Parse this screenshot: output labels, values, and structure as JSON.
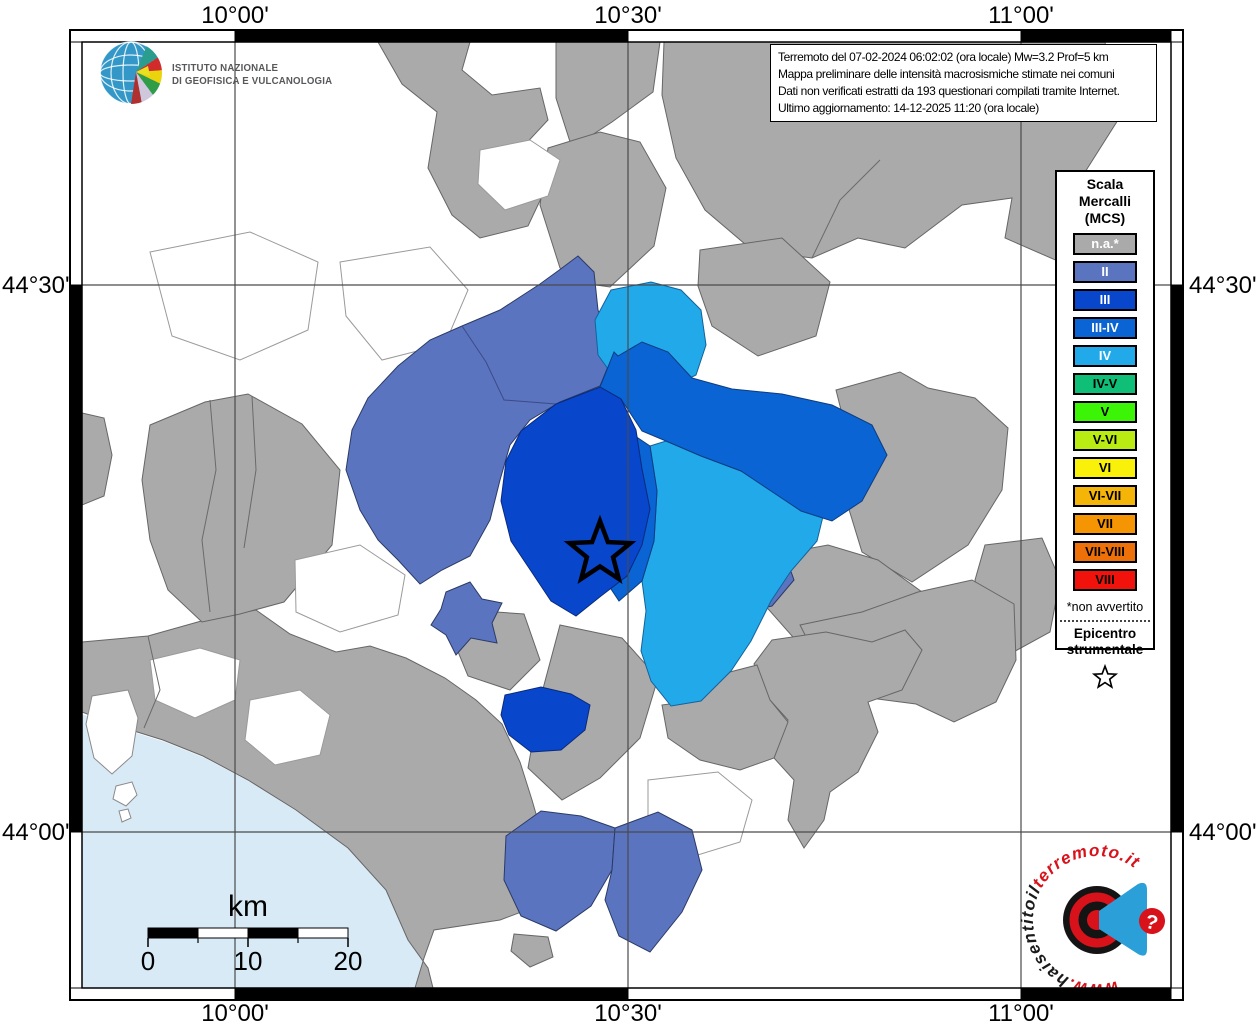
{
  "palette": {
    "na": "#aaaaaa",
    "II": "#5b74c0",
    "III": "#0846cc",
    "III_IV": "#0a64d4",
    "IV": "#22a9ea",
    "IV_V": "#10bf77",
    "V": "#3cf405",
    "V_VI": "#b9ec12",
    "VI": "#f9f10a",
    "VI_VII": "#f4b408",
    "VII": "#f69504",
    "VII_VIII": "#ee7008",
    "VIII": "#f2120c",
    "sea": "#d9eaf7",
    "white_region": "#ffffff",
    "grid": "#4a4a4a",
    "border": "#6b6b6b"
  },
  "ingv_logo": {
    "line1": "ISTITUTO NAZIONALE",
    "line2": "DI GEOFISICA E VULCANOLOGIA"
  },
  "info_box": {
    "lines": [
      "Terremoto del 07-02-2024 06:02:02 (ora locale) Mw=3.2 Prof=5 km",
      "Mappa preliminare delle intensità macrosismiche stimate nei comuni",
      "Dati non verificati estratti da 193 questionari compilati tramite Internet.",
      "Ultimo aggiornamento: 14-12-2025 11:20 (ora locale)"
    ]
  },
  "legend": {
    "title_lines": [
      "Scala",
      "Mercalli",
      "(MCS)"
    ],
    "items": [
      {
        "label": "n.a.*"
      },
      {
        "label": "II"
      },
      {
        "label": "III"
      },
      {
        "label": "III-IV"
      },
      {
        "label": "IV"
      },
      {
        "label": "IV-V"
      },
      {
        "label": "V"
      },
      {
        "label": "V-VI"
      },
      {
        "label": "VI"
      },
      {
        "label": "VI-VII"
      },
      {
        "label": "VII"
      },
      {
        "label": "VII-VIII"
      },
      {
        "label": "VIII"
      }
    ],
    "footnote": "*non avvertito",
    "epicenter_lines": [
      "Epicentro",
      "strumentale"
    ]
  },
  "axis_labels": {
    "top": [
      "10°00'",
      "10°30'",
      "11°00'"
    ],
    "bottom": [
      "10°00'",
      "10°30'",
      "11°00'"
    ],
    "left": [
      "44°30'",
      "44°00'"
    ],
    "right": [
      "44°30'",
      "44°00'"
    ]
  },
  "scale_bar": {
    "unit": "km",
    "tick_labels": [
      "0",
      "10",
      "20"
    ]
  },
  "watermark": {
    "red_prefix": "www.",
    "black_text": "haisentitoil",
    "red_suffix": "terremoto.it",
    "qmark": "?"
  }
}
